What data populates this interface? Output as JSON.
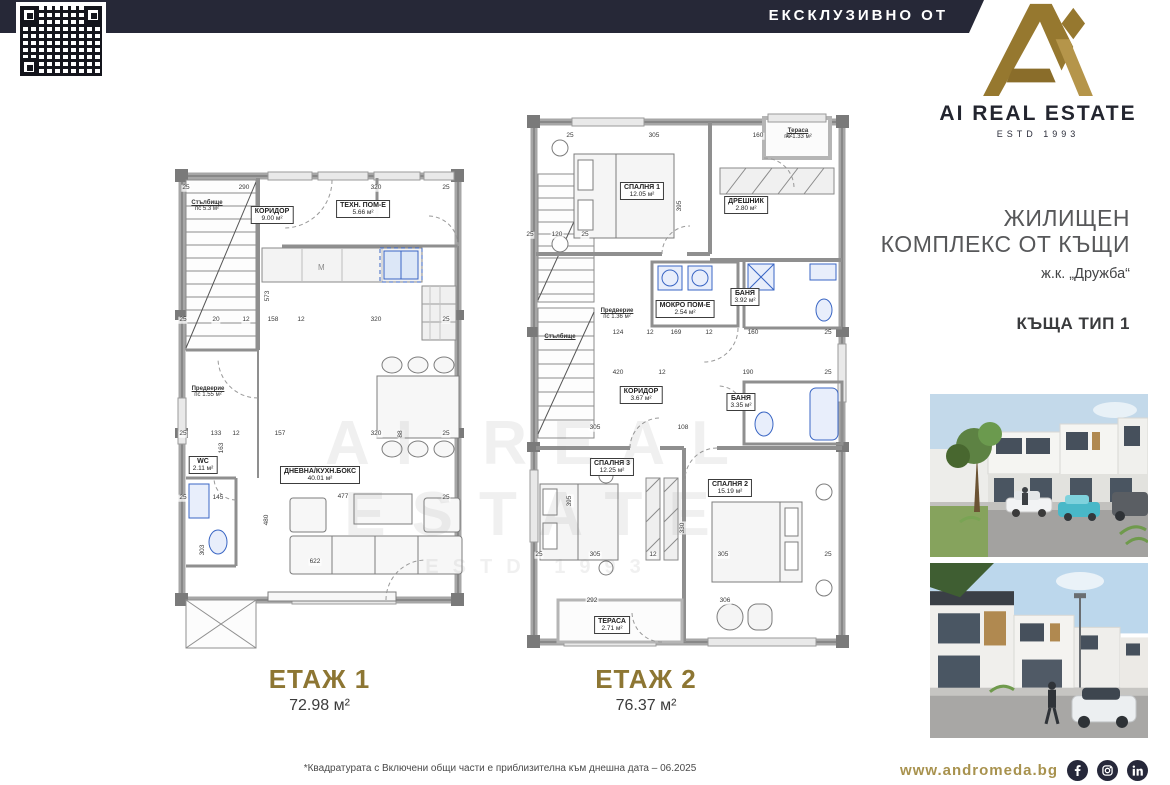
{
  "banner": {
    "label": "ЕКСКЛУЗИВНО ОТ"
  },
  "logo": {
    "name": "AI REAL ESTATE",
    "estd": "ESTD 1993"
  },
  "sidebar": {
    "title_line1": "ЖИЛИЩЕН",
    "title_line2": "КОМПЛЕКС ОТ КЪЩИ",
    "location": "ж.к. „Дружба“",
    "house_type": "КЪЩА ТИП 1",
    "website": "www.andromeda.bg"
  },
  "watermark": {
    "line1": "AI REAL ESTATE",
    "line2": "ESTD 1993"
  },
  "floor1": {
    "caption": "ЕТАЖ 1",
    "total_area": "72.98 м²",
    "kitchen_mark": "М",
    "rooms": {
      "stairs": {
        "name": "Стълбище",
        "area": "пс 5.3 м²"
      },
      "corridor": {
        "name": "КОРИДОР",
        "area": "9.00 м²"
      },
      "tech": {
        "name": "ТЕХН. ПОМ-Е",
        "area": "5.66 м²"
      },
      "vestibule": {
        "name": "Предверие",
        "area": "пс 1.55 м²"
      },
      "wc": {
        "name": "WC",
        "area": "2.11 м²"
      },
      "living": {
        "name": "ДНЕВНА/КУХН.БОКС",
        "area": "40.01 м²"
      }
    },
    "dims": [
      "25",
      "290",
      "320",
      "25",
      "573",
      "25",
      "20",
      "12",
      "158",
      "12",
      "320",
      "25",
      "25",
      "133",
      "12",
      "157",
      "320",
      "88",
      "25",
      "25",
      "145",
      "477",
      "25",
      "480",
      "622",
      "163",
      "303"
    ]
  },
  "floor2": {
    "caption": "ЕТАЖ 2",
    "total_area": "76.37 м²",
    "rooms": {
      "bedroom1": {
        "name": "СПАЛНЯ 1",
        "area": "12.05 м²"
      },
      "terrace_top": {
        "name": "Тераса",
        "area": "пс 1.33 м²"
      },
      "closet": {
        "name": "ДРЕШНИК",
        "area": "2.80 м²"
      },
      "bath1": {
        "name": "БАНЯ",
        "area": "3.92 м²"
      },
      "wet_room": {
        "name": "МОКРО ПОМ-Е",
        "area": "2.54 м²"
      },
      "vestibule": {
        "name": "Предверие",
        "area": "пс 1.36 м²"
      },
      "stairs": {
        "name": "Стълбище",
        "area": ""
      },
      "corridor": {
        "name": "КОРИДОР",
        "area": "3.67 м²"
      },
      "bath2": {
        "name": "БАНЯ",
        "area": "3.35 м²"
      },
      "bedroom3": {
        "name": "СПАЛНЯ 3",
        "area": "12.25 м²"
      },
      "bedroom2": {
        "name": "СПАЛНЯ 2",
        "area": "15.19 м²"
      },
      "terrace_bottom": {
        "name": "ТЕРАСА",
        "area": "2.71 м²"
      }
    },
    "dims": [
      "25",
      "305",
      "160",
      "12",
      "25",
      "120",
      "25",
      "395",
      "124",
      "12",
      "169",
      "12",
      "160",
      "25",
      "420",
      "12",
      "190",
      "25",
      "305",
      "108",
      "25",
      "305",
      "12",
      "305",
      "25",
      "292",
      "306",
      "395",
      "330"
    ]
  },
  "footer": {
    "disclaimer": "*Квадратурата с Включени общи части е приблизителна към днешна дата – 06.2025"
  },
  "colors": {
    "navy": "#262837",
    "gold": "#96782f",
    "gold_light": "#b5954a",
    "caption_gold": "#8d7633",
    "fixture_blue": "#3a66c4",
    "wall_gray": "#a6a6a6"
  }
}
